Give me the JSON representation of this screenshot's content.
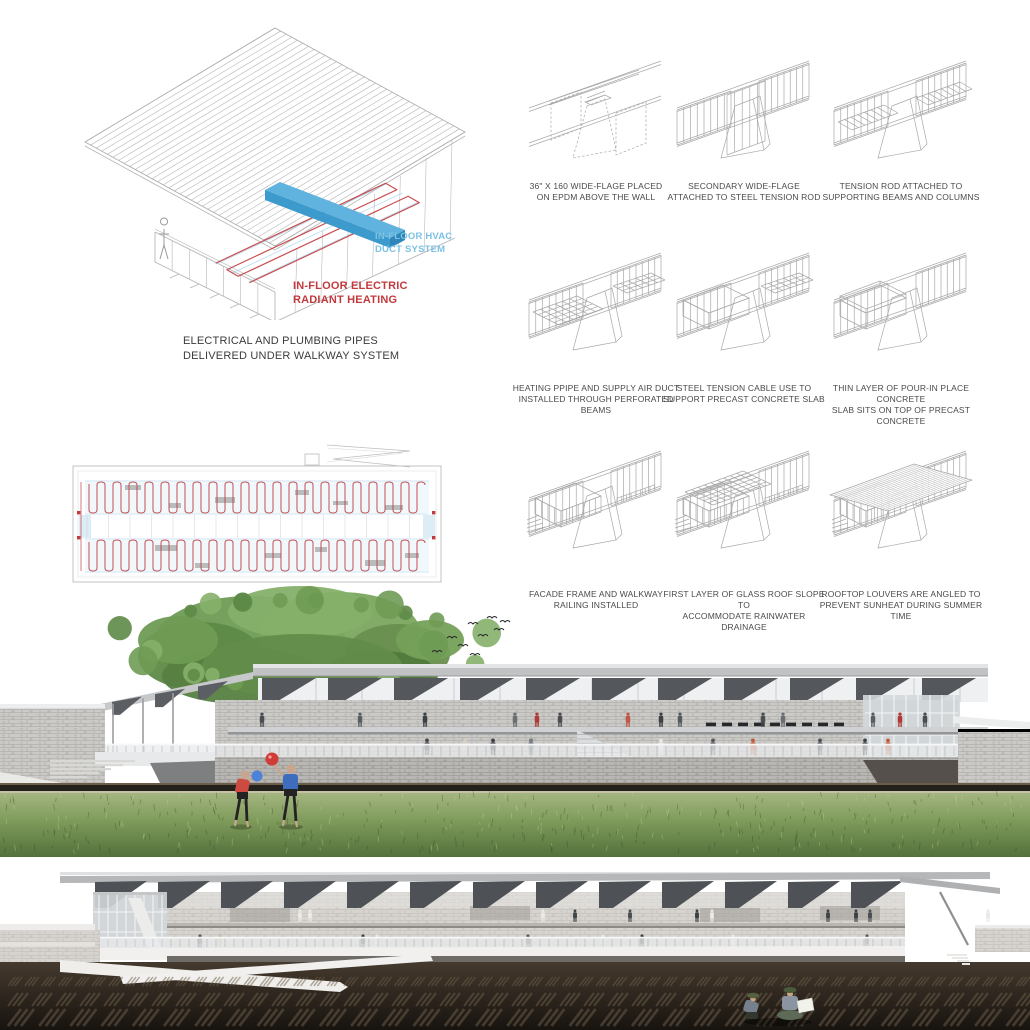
{
  "axon": {
    "labels": {
      "hvac": "IN-FLOOR HVAC\nDUCT SYSTEM",
      "electric": "IN-FLOOR ELECTRIC\nRADIANT HEATING",
      "caption": "ELECTRICAL AND PLUMBING PIPES\nDELIVERED UNDER WALKWAY SYSTEM"
    },
    "colors": {
      "hvac_label": "#7cc2e4",
      "electric_label": "#c23a3e",
      "caption": "#3b3b3b",
      "line": "#b5b5b5",
      "coil": "#c23a3e",
      "water": "#a9d2e8",
      "duct_top": "#5fb3de",
      "duct_front": "#3d9acc",
      "duct_end": "#2f86b8"
    }
  },
  "steps": {
    "line_color": "#a8a8a8",
    "text_color": "#4a4a4a",
    "items": [
      {
        "caption": "36\" X 160 WIDE-FLAGE PLACED\nON EPDM ABOVE THE WALL",
        "features": [
          "beamTop",
          "dashedPier",
          "dashedVolumes",
          "epdmPad"
        ]
      },
      {
        "caption": "SECONDARY WIDE-FLAGE\nATTACHED TO STEEL TENSION ROD",
        "features": [
          "pier",
          "wallsL",
          "wallsR",
          "hangPlane"
        ]
      },
      {
        "caption": "TENSION ROD ATTACHED TO\nSUPPORTING BEAMS AND COLUMNS",
        "features": [
          "pier",
          "wallsL",
          "wallsR",
          "joistsL",
          "joistsR"
        ]
      },
      {
        "caption": "HEATING PPIPE AND SUPPLY AIR DUCT\nINSTALLED THROUGH PERFORATED BEAMS",
        "features": [
          "pier",
          "wallsL",
          "wallsR",
          "gridL",
          "gridR"
        ]
      },
      {
        "caption": "STEEL TENSION CABLE USE TO\nSUPPORT PRECAST CONCRETE SLAB",
        "features": [
          "pier",
          "wallsL",
          "wallsR",
          "boxL",
          "gridR"
        ]
      },
      {
        "caption": "THIN LAYER OF POUR-IN PLACE CONCRETE\nSLAB SITS ON TOP OF PRECAST CONCRETE",
        "features": [
          "pier",
          "wallsL",
          "wallsR",
          "boxL",
          "slabTop"
        ]
      },
      {
        "caption": "FACADE FRAME AND WALKWAY\nRAILING INSTALLED",
        "features": [
          "pier",
          "wallsL",
          "wallsR",
          "boxL",
          "mullions",
          "stair",
          "railposts"
        ]
      },
      {
        "caption": "FIRST LAYER OF GLASS ROOF SLOPE TO\nACCOMMODATE RAINWATER DRAINAGE",
        "features": [
          "pier",
          "wallsL",
          "wallsR",
          "boxL",
          "mullions",
          "stair",
          "glassGrid",
          "railposts"
        ]
      },
      {
        "caption": "ROOFTOP LOUVERS ARE ANGLED  TO\nPREVENT SUNHEAT DURING SUMMER TIME",
        "features": [
          "pier",
          "wallsL",
          "wallsR",
          "boxL",
          "mullions",
          "stair",
          "louverRoof"
        ]
      }
    ]
  },
  "plan": {
    "coil_color": "#c23a3e",
    "water_color": "#a9d2e8",
    "line_color": "#bdbdbd"
  },
  "render_park": {
    "palette": {
      "roof_fascia": "#c0c2c4",
      "fin": "#54585c",
      "stone": "#cbcac7",
      "railing": "#e9ebec",
      "grass_light": "#a4b57f",
      "grass_dark": "#54703c",
      "tree_mid": "#6f9b54",
      "tree_dark": "#4f7a3c",
      "tree_light": "#85b06a",
      "ground_strip": "#24201b",
      "balloon_red": "#cf3b35",
      "balloon_blue": "#4d82d8",
      "shirt_red": "#cc4a40",
      "shirt_blue": "#3f6dbd"
    }
  },
  "render_field": {
    "palette": {
      "roof_fascia": "#b5b7b9",
      "fin": "#4e5257",
      "stone": "#d7d4d0",
      "ramp_white": "#f1f0ee",
      "soil_light": "#453a2e",
      "soil_dark": "#17130f",
      "till_mark": "#6e5e4a",
      "hat_green": "#4c5a3c",
      "paper": "#f2f2ec"
    }
  }
}
